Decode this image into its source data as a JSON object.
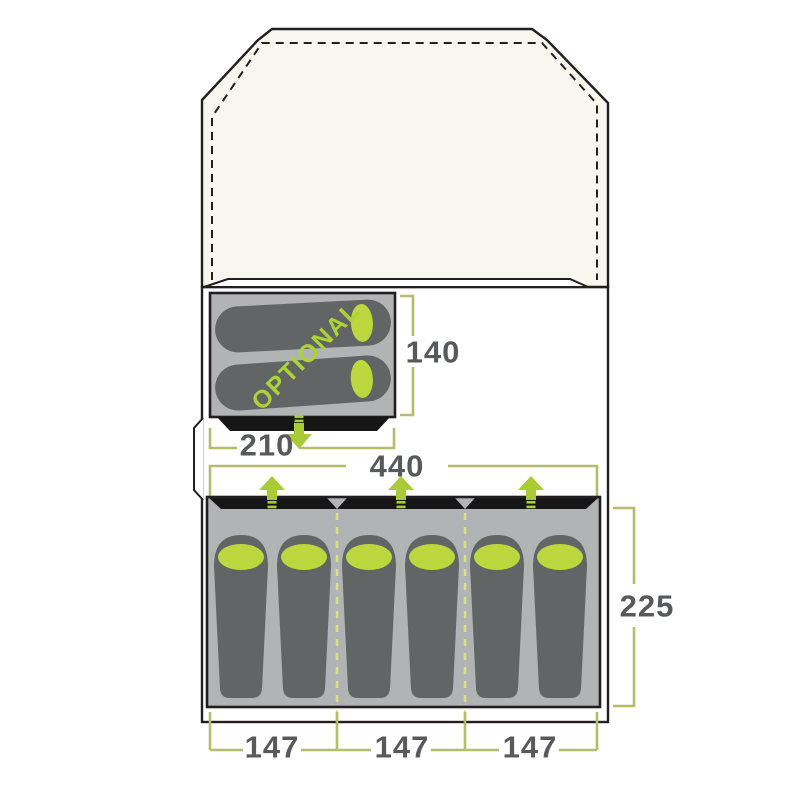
{
  "figure": {
    "type": "tent-floorplan-diagram",
    "optional_room": {
      "label": "OPTIONAL",
      "width": "210",
      "depth": "140",
      "sleeping_bags": 2
    },
    "main_bedroom": {
      "width": "440",
      "depth": "225",
      "sections": [
        "147",
        "147",
        "147"
      ],
      "sleeping_bags": 6,
      "front_doors": 3
    }
  },
  "colors": {
    "accent_green": "#a9cb35",
    "pillow_green": "#bfd73f",
    "optional_text_green": "#aed136",
    "divider_dash_green": "#dae18c",
    "dimension_bracket_olive": "#b4bc6d",
    "dimension_text_gray": "#58595b",
    "room_gray": "#b1b3b5",
    "sleeping_bag_gray": "#626466",
    "door_strip_black": "#161616",
    "outline_black": "#231f20",
    "porch_cream": "#f7f7ef",
    "background": "#ffffff"
  }
}
